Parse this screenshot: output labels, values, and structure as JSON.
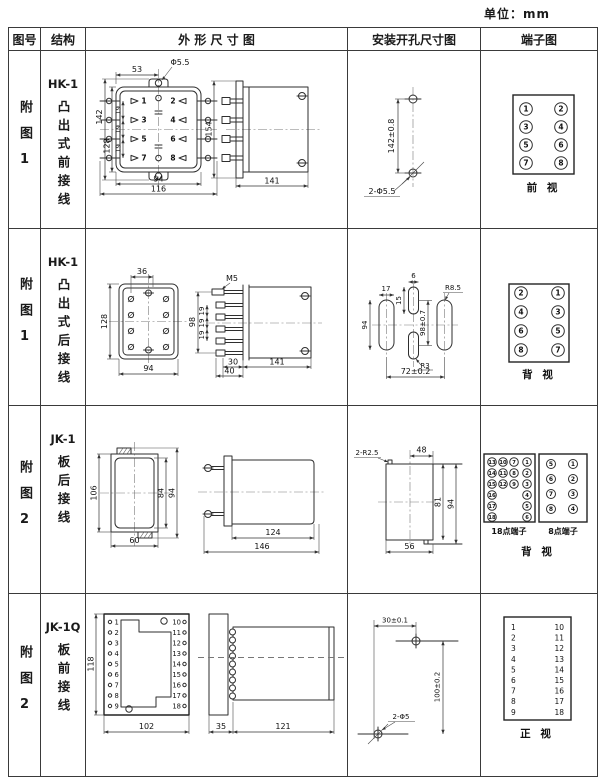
{
  "unit_label": "单位：mm",
  "header": {
    "fig": "图号",
    "structure": "结构",
    "outline": "外 形 尺 寸 图",
    "install": "安装开孔尺寸图",
    "terminal": "端子图"
  },
  "rows": [
    {
      "fig_no": "附图1",
      "model": "HK-1",
      "wiring": "凸出式前接线",
      "outline": {
        "front": {
          "w_top": "53",
          "hole": "Φ5.5",
          "h_total": "142",
          "h_body": "128",
          "p1": "19",
          "p2": "19",
          "p3": "19",
          "w_body": "94",
          "w_total": "116",
          "t": [
            "1",
            "2",
            "3",
            "4",
            "5",
            "6",
            "7",
            "8"
          ]
        },
        "side": {
          "h": "154",
          "w": "141"
        }
      },
      "install": {
        "v": "142±0.8",
        "holes": "2-Φ5.5"
      },
      "terminal": {
        "c": [
          "1",
          "2",
          "3",
          "4",
          "5",
          "6",
          "7",
          "8"
        ],
        "view": "前  视"
      }
    },
    {
      "fig_no": "附图1",
      "model": "HK-1",
      "wiring": "凸出式后接线",
      "outline": {
        "front": {
          "w_top": "36",
          "h": "128",
          "w": "94"
        },
        "side": {
          "screw": "M5",
          "h": "98",
          "p1": "19",
          "p2": "19",
          "p3": "19",
          "w1": "30",
          "w2": "40",
          "w": "141"
        }
      },
      "install": {
        "d17": "17",
        "d6": "6",
        "d15": "15",
        "h94": "94",
        "v": "98±0.7",
        "r1": "R8.5",
        "r2": "R3",
        "w": "72±0.2"
      },
      "terminal": {
        "c": [
          "2",
          "1",
          "4",
          "3",
          "6",
          "5",
          "8",
          "7"
        ],
        "view": "背  视"
      }
    },
    {
      "fig_no": "附图2",
      "model": "JK-1",
      "wiring": "板后接线",
      "outline": {
        "front": {
          "h": "106",
          "w": "60",
          "h_in": "84",
          "h_out": "94"
        },
        "side": {
          "w_in": "124",
          "w_out": "146"
        }
      },
      "install": {
        "notch": "2-R2.5",
        "w_top": "48",
        "h_in": "81",
        "h_out": "94",
        "w_bottom": "56"
      },
      "terminal": {
        "g18": {
          "label": "18点端子",
          "c1": [
            "13",
            "14",
            "15",
            "16",
            "17",
            "18"
          ],
          "c2": [
            "10",
            "11",
            "12"
          ],
          "c3": [
            "7",
            "8",
            "9"
          ],
          "c4": [
            "1",
            "2",
            "3",
            "4",
            "5",
            "6"
          ]
        },
        "g8": {
          "label": "8点端子",
          "c1": [
            "5",
            "6",
            "7",
            "8"
          ],
          "c2": [
            "1",
            "2",
            "3",
            "4"
          ]
        },
        "view": "背  视"
      }
    },
    {
      "fig_no": "附图2",
      "model": "JK-1Q",
      "wiring": "板前接线",
      "outline": {
        "front": {
          "h": "118",
          "w": "102",
          "left": [
            "1",
            "2",
            "3",
            "4",
            "5",
            "6",
            "7",
            "8",
            "9"
          ],
          "right": [
            "10",
            "11",
            "12",
            "13",
            "14",
            "15",
            "16",
            "17",
            "18"
          ]
        },
        "side": {
          "w1": "35",
          "w2": "121"
        }
      },
      "install": {
        "w": "30±0.1",
        "h": "100±0.2",
        "holes": "2-Φ5"
      },
      "terminal": {
        "left": [
          "1",
          "2",
          "3",
          "4",
          "5",
          "6",
          "7",
          "8",
          "9"
        ],
        "right": [
          "10",
          "11",
          "12",
          "13",
          "14",
          "15",
          "16",
          "17",
          "18"
        ],
        "view": "正  视"
      }
    }
  ]
}
